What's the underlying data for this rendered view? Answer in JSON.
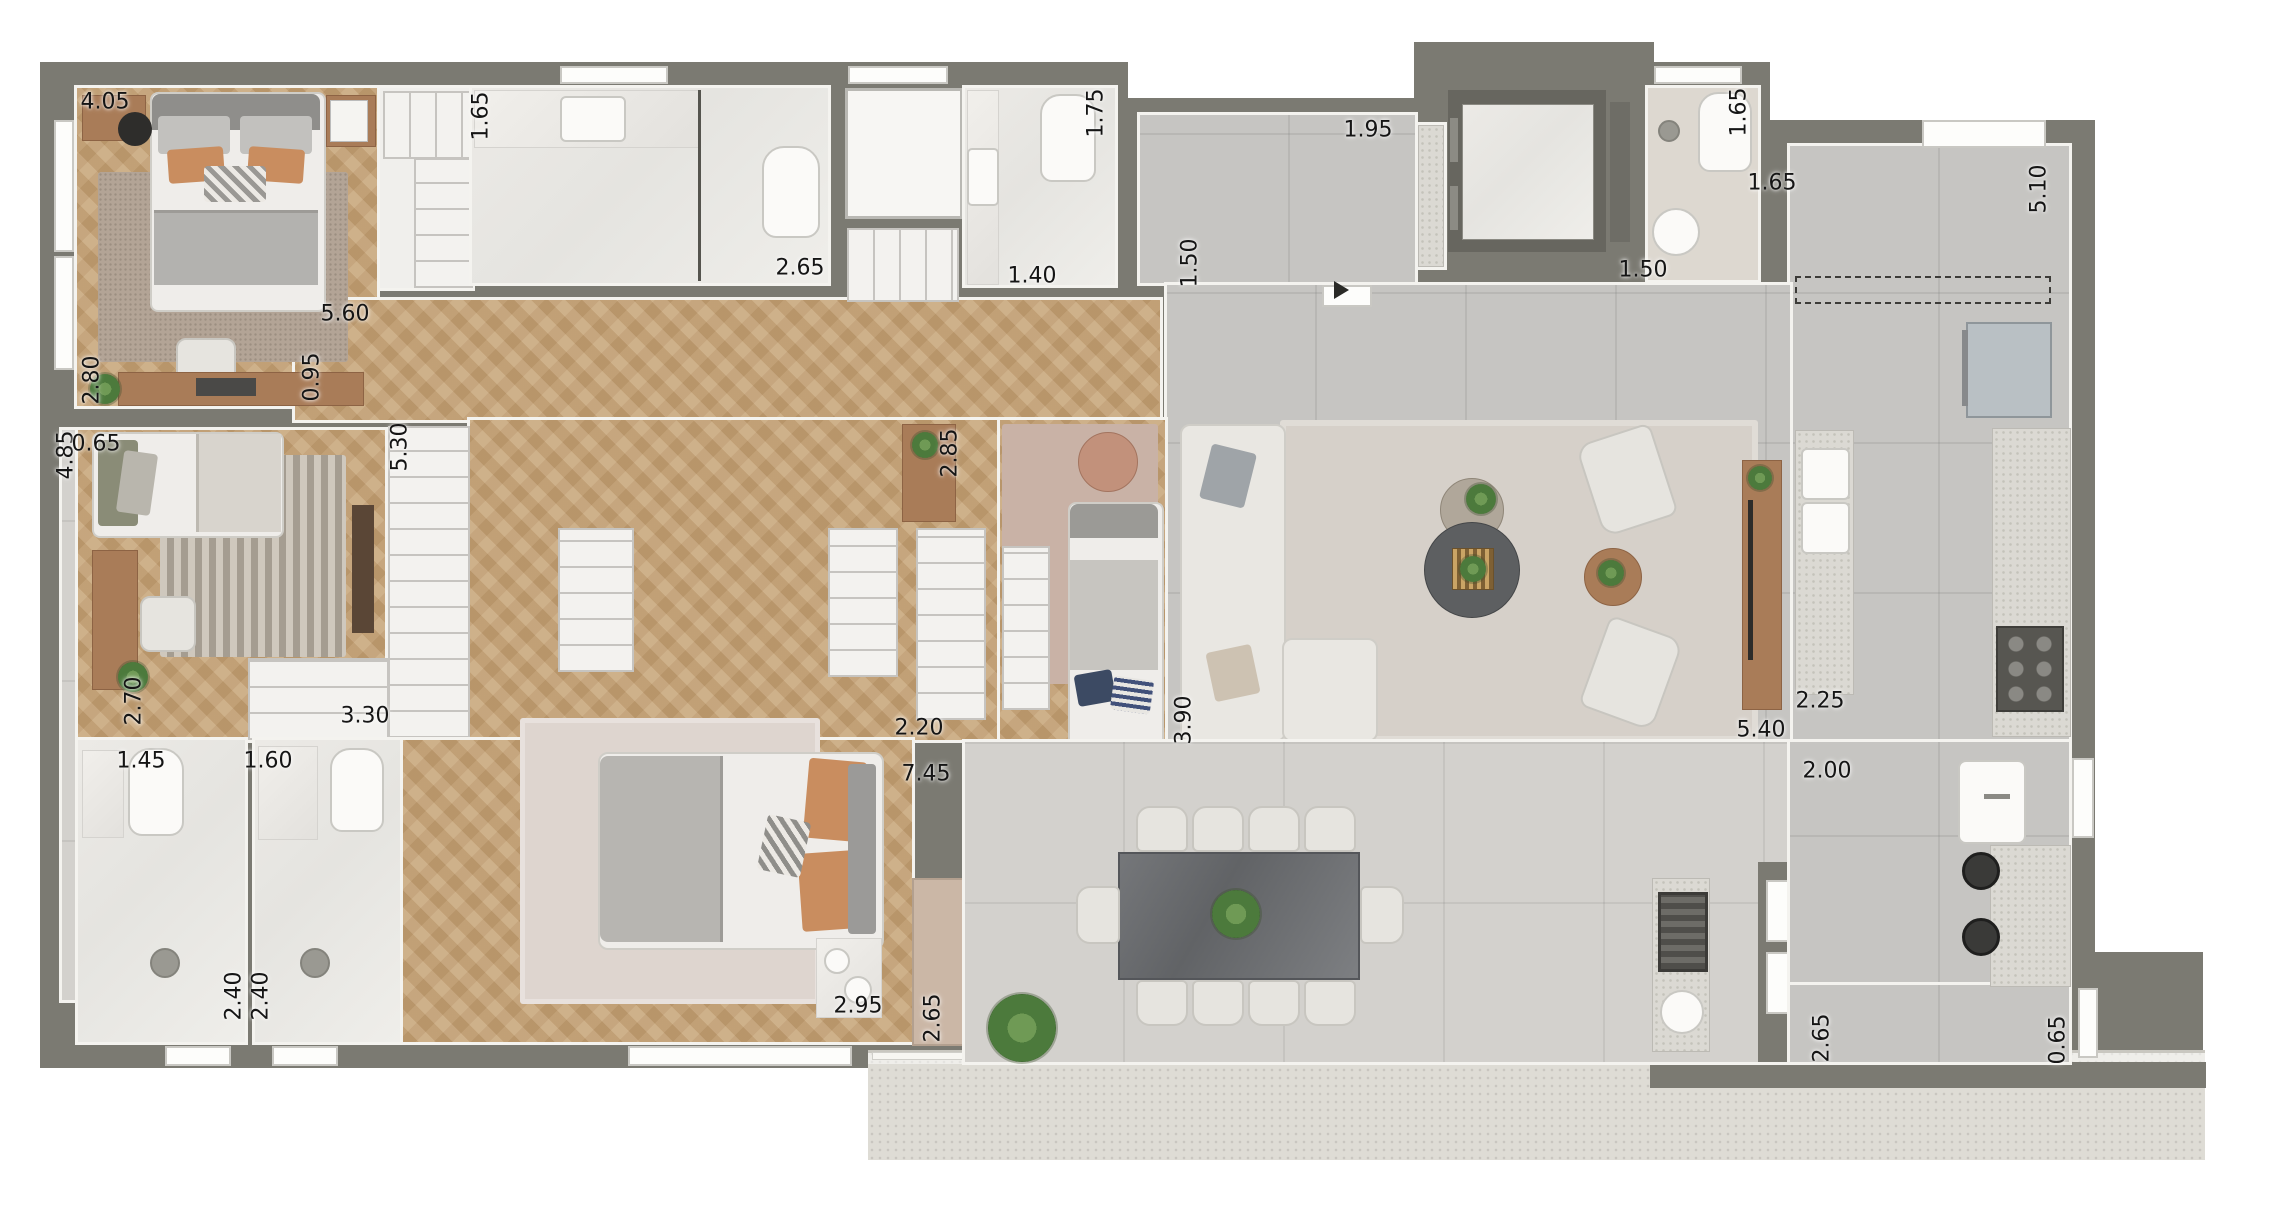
{
  "canvas": {
    "width": 2280,
    "height": 1208
  },
  "palette": {
    "wall": "#7b7a72",
    "wall_lining": "#f4f3ef",
    "wood_floor": "#c4a277",
    "gray_tile_floor": "#c6c5c2",
    "terrace_tile_floor": "#d3d1cd",
    "terrace_apron": "#dedcd5",
    "marble_bathroom": "#e9e8e4",
    "granite_counter": "#dbd9d3",
    "accent_wood_furniture": "#a97c58",
    "dining_table_stone": "#6e7072",
    "plant_green": "#4c7a3c",
    "door_panel_beige": "#cbb7a6",
    "label_text": "#151515"
  },
  "dimension_labels": [
    {
      "text": "4.05",
      "x": 105,
      "y": 102,
      "vertical": false
    },
    {
      "text": "2.80",
      "x": 92,
      "y": 380,
      "vertical": true
    },
    {
      "text": "1.65",
      "x": 481,
      "y": 116,
      "vertical": true
    },
    {
      "text": "2.65",
      "x": 800,
      "y": 268,
      "vertical": false
    },
    {
      "text": "5.60",
      "x": 345,
      "y": 314,
      "vertical": false
    },
    {
      "text": "0.95",
      "x": 312,
      "y": 377,
      "vertical": true
    },
    {
      "text": "1.40",
      "x": 1032,
      "y": 276,
      "vertical": false
    },
    {
      "text": "1.75",
      "x": 1096,
      "y": 113,
      "vertical": true
    },
    {
      "text": "1.95",
      "x": 1368,
      "y": 130,
      "vertical": false
    },
    {
      "text": "1.50",
      "x": 1190,
      "y": 263,
      "vertical": true
    },
    {
      "text": "1.50",
      "x": 1643,
      "y": 270,
      "vertical": false
    },
    {
      "text": "1.65",
      "x": 1739,
      "y": 112,
      "vertical": true
    },
    {
      "text": "1.65",
      "x": 1772,
      "y": 183,
      "vertical": false
    },
    {
      "text": "5.10",
      "x": 2039,
      "y": 189,
      "vertical": true
    },
    {
      "text": "4.85",
      "x": 66,
      "y": 455,
      "vertical": true
    },
    {
      "text": "0.65",
      "x": 96,
      "y": 444,
      "vertical": false
    },
    {
      "text": "5.30",
      "x": 400,
      "y": 447,
      "vertical": true
    },
    {
      "text": "2.70",
      "x": 134,
      "y": 701,
      "vertical": true
    },
    {
      "text": "3.30",
      "x": 365,
      "y": 716,
      "vertical": false
    },
    {
      "text": "1.45",
      "x": 141,
      "y": 761,
      "vertical": false
    },
    {
      "text": "1.60",
      "x": 268,
      "y": 761,
      "vertical": false
    },
    {
      "text": "2.85",
      "x": 950,
      "y": 453,
      "vertical": true
    },
    {
      "text": "2.20",
      "x": 919,
      "y": 728,
      "vertical": false
    },
    {
      "text": "7.45",
      "x": 926,
      "y": 774,
      "vertical": false
    },
    {
      "text": "3.90",
      "x": 1184,
      "y": 720,
      "vertical": true
    },
    {
      "text": "2.40",
      "x": 234,
      "y": 996,
      "vertical": true
    },
    {
      "text": "2.40",
      "x": 261,
      "y": 996,
      "vertical": true
    },
    {
      "text": "2.95",
      "x": 858,
      "y": 1006,
      "vertical": false
    },
    {
      "text": "2.65",
      "x": 933,
      "y": 1018,
      "vertical": true
    },
    {
      "text": "2.25",
      "x": 1820,
      "y": 701,
      "vertical": false
    },
    {
      "text": "5.40",
      "x": 1761,
      "y": 730,
      "vertical": false
    },
    {
      "text": "2.00",
      "x": 1827,
      "y": 771,
      "vertical": false
    },
    {
      "text": "2.65",
      "x": 1822,
      "y": 1038,
      "vertical": true
    },
    {
      "text": "0.65",
      "x": 2058,
      "y": 1040,
      "vertical": true
    }
  ],
  "icon_names": [
    "double-bed-icon",
    "single-bed-icon",
    "king-bed-icon",
    "pillow-icon",
    "rug-icon",
    "desk-icon",
    "office-chair-icon",
    "wardrobe-icon",
    "toilet-icon",
    "sink-icon",
    "shower-icon",
    "bathtub-vanity-icon",
    "sofa-icon",
    "armchair-icon",
    "coffee-table-icon",
    "side-table-icon",
    "tv-console-icon",
    "dining-table-icon",
    "dining-chair-icon",
    "kitchen-counter-icon",
    "cooktop-icon",
    "fridge-icon",
    "laundry-tank-icon",
    "bbq-grill-icon",
    "bar-stool-icon",
    "elevator-icon",
    "plant-icon",
    "entry-arrow-icon",
    "window-icon",
    "overhead-cabinet-dashed-icon",
    "pouf-icon"
  ]
}
